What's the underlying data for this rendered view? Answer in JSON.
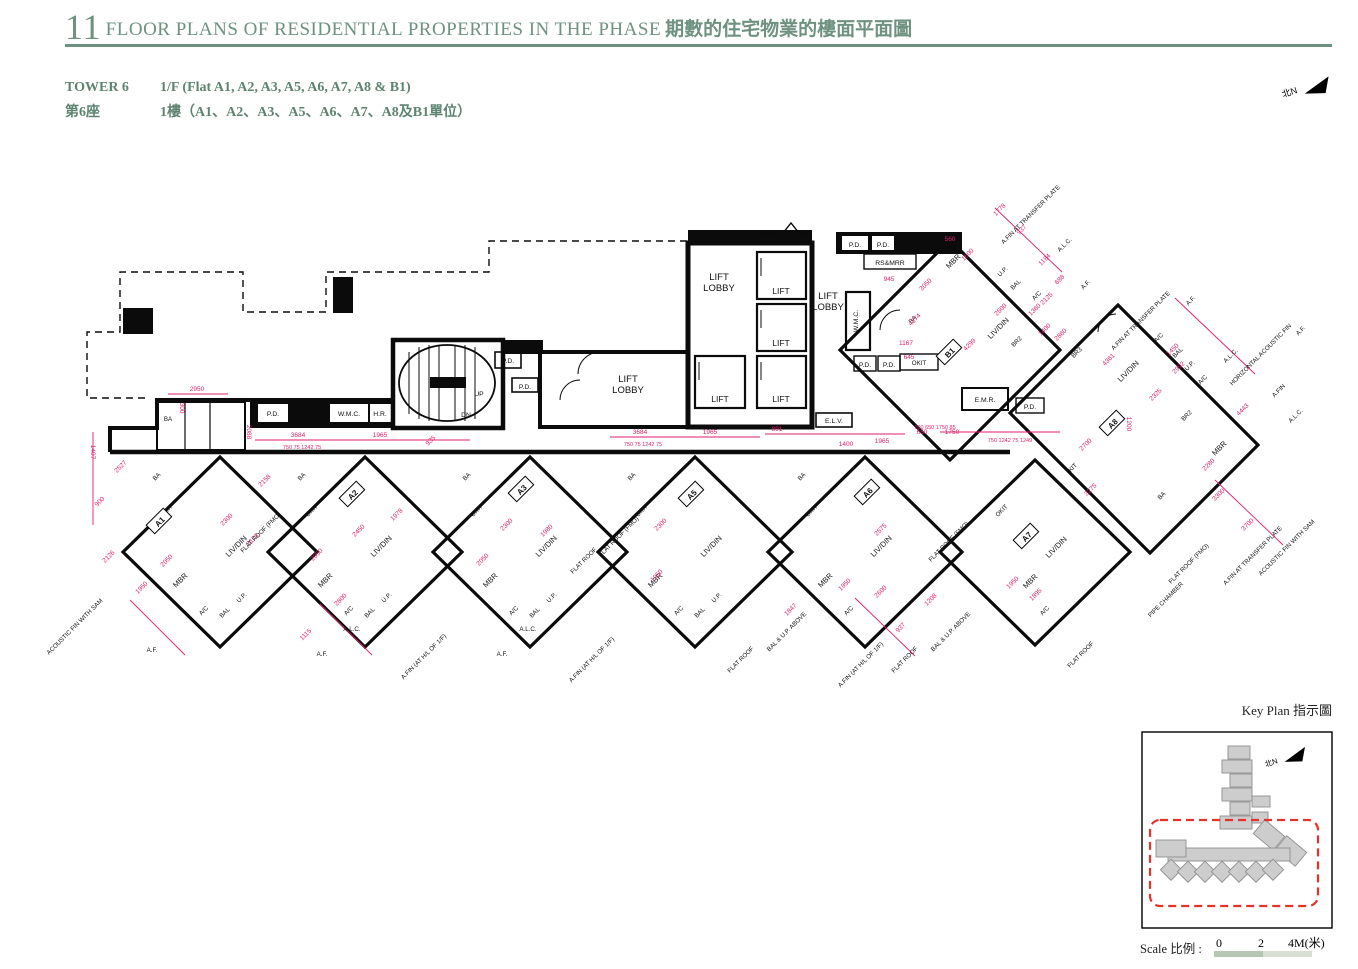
{
  "header": {
    "section_number": "11",
    "title_en": "FLOOR PLANS OF RESIDENTIAL PROPERTIES IN THE PHASE",
    "title_zh": "期數的住宅物業的樓面平面圖"
  },
  "tower_info": {
    "tower_en": "TOWER 6",
    "floor_en": "1/F (Flat A1, A2, A3, A5, A6, A7, A8 & B1)",
    "tower_zh": "第6座",
    "floor_zh": "1樓（A1、A2、A3、A5、A6、A7、A8及B1單位）"
  },
  "north_arrow": {
    "label": "北N"
  },
  "key_plan": {
    "title": "Key Plan 指示圖",
    "north_label": "北N"
  },
  "scale_bar": {
    "label": "Scale 比例 :",
    "tick0": "0",
    "tick1": "2",
    "tick2": "4M(米)"
  },
  "colors": {
    "header_green": "#6e9180",
    "dim_pink": "#e01e6f",
    "flat_light": "#c7cedf",
    "flat_dark": "#8894b6",
    "flat_mid": "#b7c0d6",
    "flat_teal": "#cfe2d9",
    "keyplan_red": "#e63329",
    "scale_dark": "#b5c6b3",
    "scale_light": "#d9ded4"
  },
  "plan": {
    "lift": "LIFT",
    "lobby1": "LIFT",
    "lobby2": "LOBBY",
    "rooms": {
      "ba": "BA",
      "okit": "OKIT",
      "liv_din": "LIV/DIN",
      "mbr": "MBR",
      "ac": "A/C",
      "bal": "BAL",
      "up": "U.P.",
      "br2": "BR2",
      "br3": "BR3",
      "kit": "KIT",
      "flat_roof": "FLAT ROOF"
    },
    "flats": [
      {
        "id": "A1"
      },
      {
        "id": "A2"
      },
      {
        "id": "A3"
      },
      {
        "id": "A5"
      },
      {
        "id": "A6"
      },
      {
        "id": "A7"
      },
      {
        "id": "A8"
      },
      {
        "id": "B1"
      }
    ],
    "services": [
      "P.D.",
      "W.M.C.",
      "H.R.",
      "P.D.",
      "P.D.",
      "P.D.",
      "P.D.",
      "RS&MRR",
      "W.M.C.",
      "P.D.",
      "P.D.",
      "E.L.V.",
      "E.M.R.",
      "P.D.",
      "UP",
      "DN"
    ],
    "dims": [
      "2950",
      "300",
      "2088",
      "3684",
      "750 75 1242 75",
      "1965",
      "935",
      "3684",
      "750 75 1242 75",
      "1965",
      "891",
      "1400",
      "1965",
      "100 650 1750 85",
      "750 1242 75 1249",
      "1200",
      "1407",
      "2527",
      "900",
      "2126",
      "1950",
      "2050",
      "2300",
      "3173",
      "2158",
      "2050",
      "2450",
      "1978",
      "2300",
      "1980",
      "2050",
      "2300",
      "1950",
      "2575",
      "1950",
      "3275",
      "1895",
      "1950",
      "4274",
      "4299",
      "2500",
      "3050",
      "1600",
      "560",
      "1778",
      "937",
      "1184",
      "688",
      "1360",
      "1400",
      "4361",
      "2860",
      "2325",
      "2992",
      "1450",
      "2280",
      "3300",
      "3700",
      "4443",
      "2700",
      "2800",
      "1115",
      "1847",
      "1208",
      "937",
      "2600",
      "1167",
      "645",
      "945",
      "1750",
      "650",
      "2125"
    ],
    "annotations": [
      "ACOUSTIC FIN WITH SAM",
      "A.F.",
      "A.F.",
      "A.L.C.",
      "A.FIN (AT H/L OF 1/F)",
      "A.F.",
      "A.L.C.",
      "A.FIN (AT H/L OF 1/F)",
      "FLAT ROOF",
      "BAL & U.P. ABOVE",
      "A.FIN (AT H/L OF 1/F)",
      "FLAT ROOF",
      "BAL & U.P. ABOVE",
      "FLAT ROOF",
      "PIPE CHAMBER",
      "FLAT ROOF (FMO)",
      "FLAT ROOF (FMO)",
      "FLAT ROOF (FMO)",
      "FLAT ROOF",
      "A.FIN AT TRANSFER PLATE",
      "A.L.C.",
      "A.F.",
      "A.FIN AT TRANSFER PLATE",
      "A.F.",
      "A.L.C.",
      "HORIZONTAL ACOUSTIC FIN",
      "A.FIN",
      "A.L.C.",
      "A.F.",
      "A.FIN AT TRANSFER PLATE",
      "ACOUSTIC FIN WITH SAM",
      "FLAT ROOF (FMO)"
    ]
  }
}
